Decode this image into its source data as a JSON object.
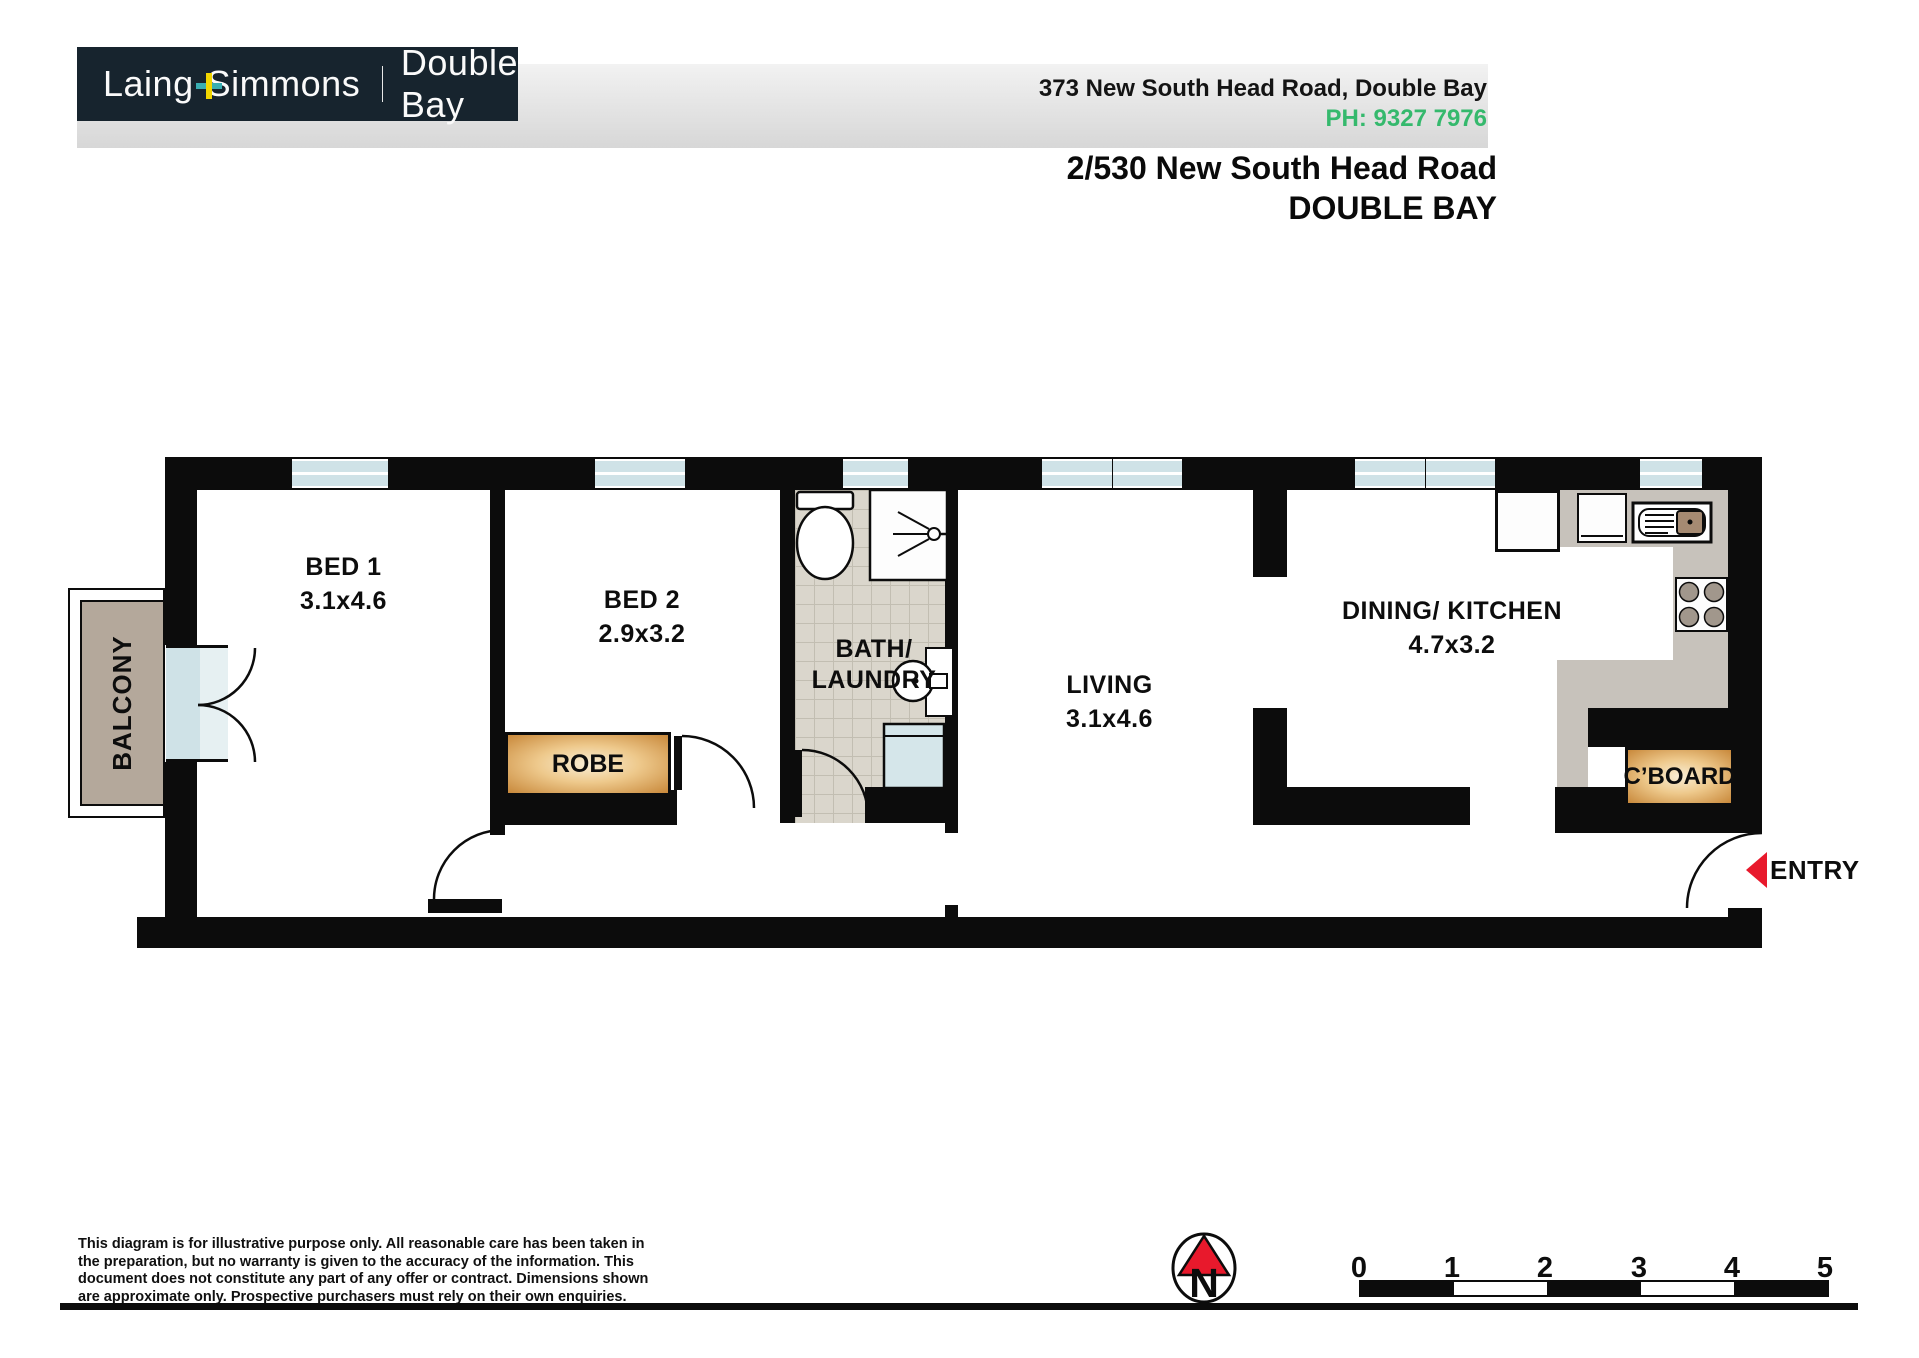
{
  "header": {
    "logo": {
      "brand_left": "Laing",
      "brand_right": "Simmons",
      "office": "Double Bay",
      "plus_icon": "plus"
    },
    "address_line": "373 New South Head Road, Double Bay",
    "phone": "PH: 9327 7976",
    "title_line1": "2/530 New South Head Road",
    "title_line2": "DOUBLE BAY"
  },
  "plan": {
    "rooms": [
      {
        "name": "BED 1",
        "dims": "3.1x4.6"
      },
      {
        "name": "BED 2",
        "dims": "2.9x3.2"
      },
      {
        "line1": "BATH/",
        "line2": "LAUNDRY"
      },
      {
        "name": "LIVING",
        "dims": "3.1x4.6"
      },
      {
        "name": "DINING/ KITCHEN",
        "dims": "4.7x3.2"
      }
    ],
    "balcony_label": "BALCONY",
    "robe_label": "ROBE",
    "cboard_label": "C’BOARD",
    "entry_label": "ENTRY"
  },
  "footer": {
    "disclaimer_lines": [
      "This diagram is for illustrative purpose only. All reasonable care has been taken in",
      "the preparation, but no warranty is given to the accuracy of the information. This",
      "document does not constitute any part of any offer or contract. Dimensions shown",
      "are approximate only. Prospective purchasers must rely on their own enquiries."
    ],
    "compass_letter": "N",
    "scale_labels": [
      "0",
      "1",
      "2",
      "3",
      "4",
      "5"
    ]
  },
  "colors": {
    "wall": "#0c0c0c",
    "navy": "#17242e",
    "green": "#35b96d",
    "red": "#e8192c",
    "window_blue": "#cfe2e7",
    "balcony_tan": "#b4a89b",
    "counter_gray": "#c7c2bb",
    "gold": "#c8883a",
    "teal": "#39aeb2",
    "yellow": "#f2d600"
  }
}
